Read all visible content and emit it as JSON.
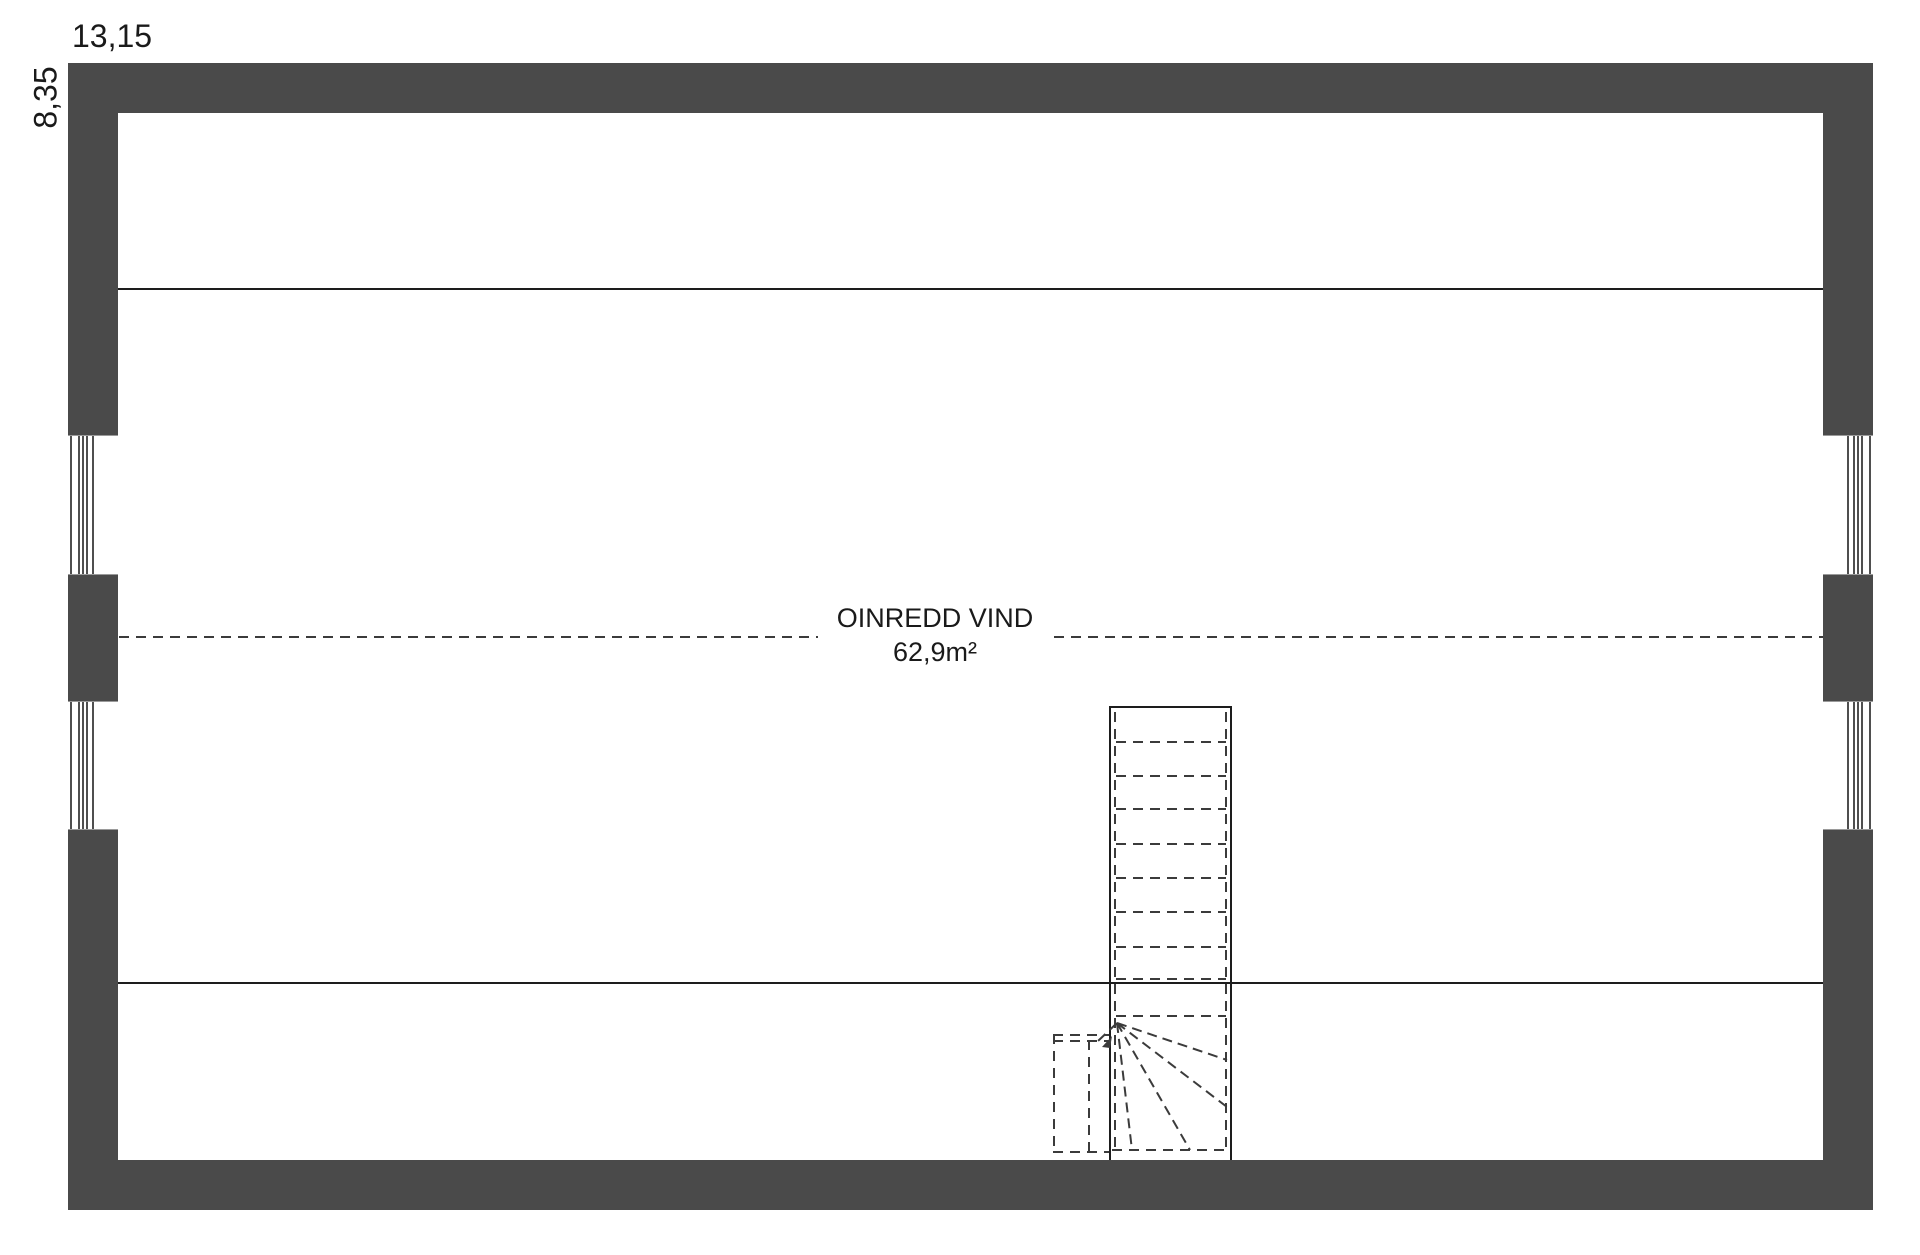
{
  "floorplan": {
    "dimensions": {
      "width_label": "13,15",
      "height_label": "8,35"
    },
    "room": {
      "name": "OINREDD VIND",
      "area": "62,9m²"
    },
    "features": {
      "stair": "staircase-with-winder",
      "windows_left": 2,
      "windows_right": 2
    },
    "colors": {
      "wall": "#4a4a4a",
      "line": "#1d1d1d",
      "dash": "#3b3b3b",
      "text": "#1a1a1a",
      "background": "#ffffff",
      "window_edge": "#9a9a9a"
    }
  }
}
